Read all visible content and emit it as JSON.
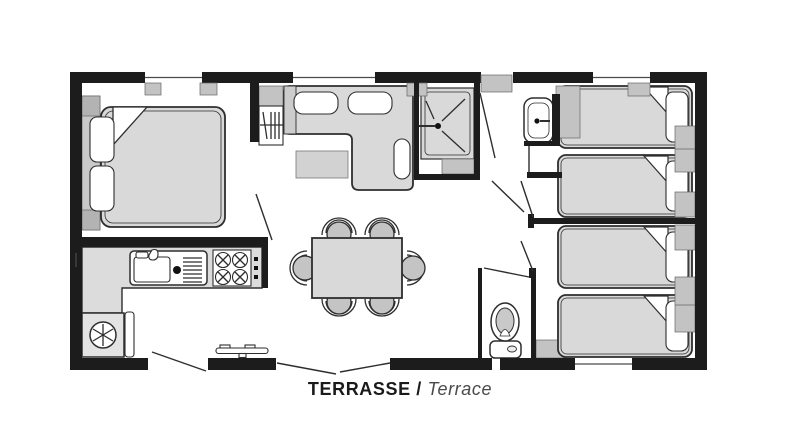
{
  "caption": {
    "primary": "TERRASSE /",
    "secondary": "Terrace"
  },
  "colors": {
    "wall": "#1c1c1c",
    "outline": "#2e2e2e",
    "furniture": "#d9d9d9",
    "counter": "#dcdcdc",
    "block": "#c3c3c3",
    "fixture": "#ffffff",
    "background": "#ffffff",
    "label_primary": "#1a1a1a",
    "label_secondary": "#4a4a4a"
  }
}
